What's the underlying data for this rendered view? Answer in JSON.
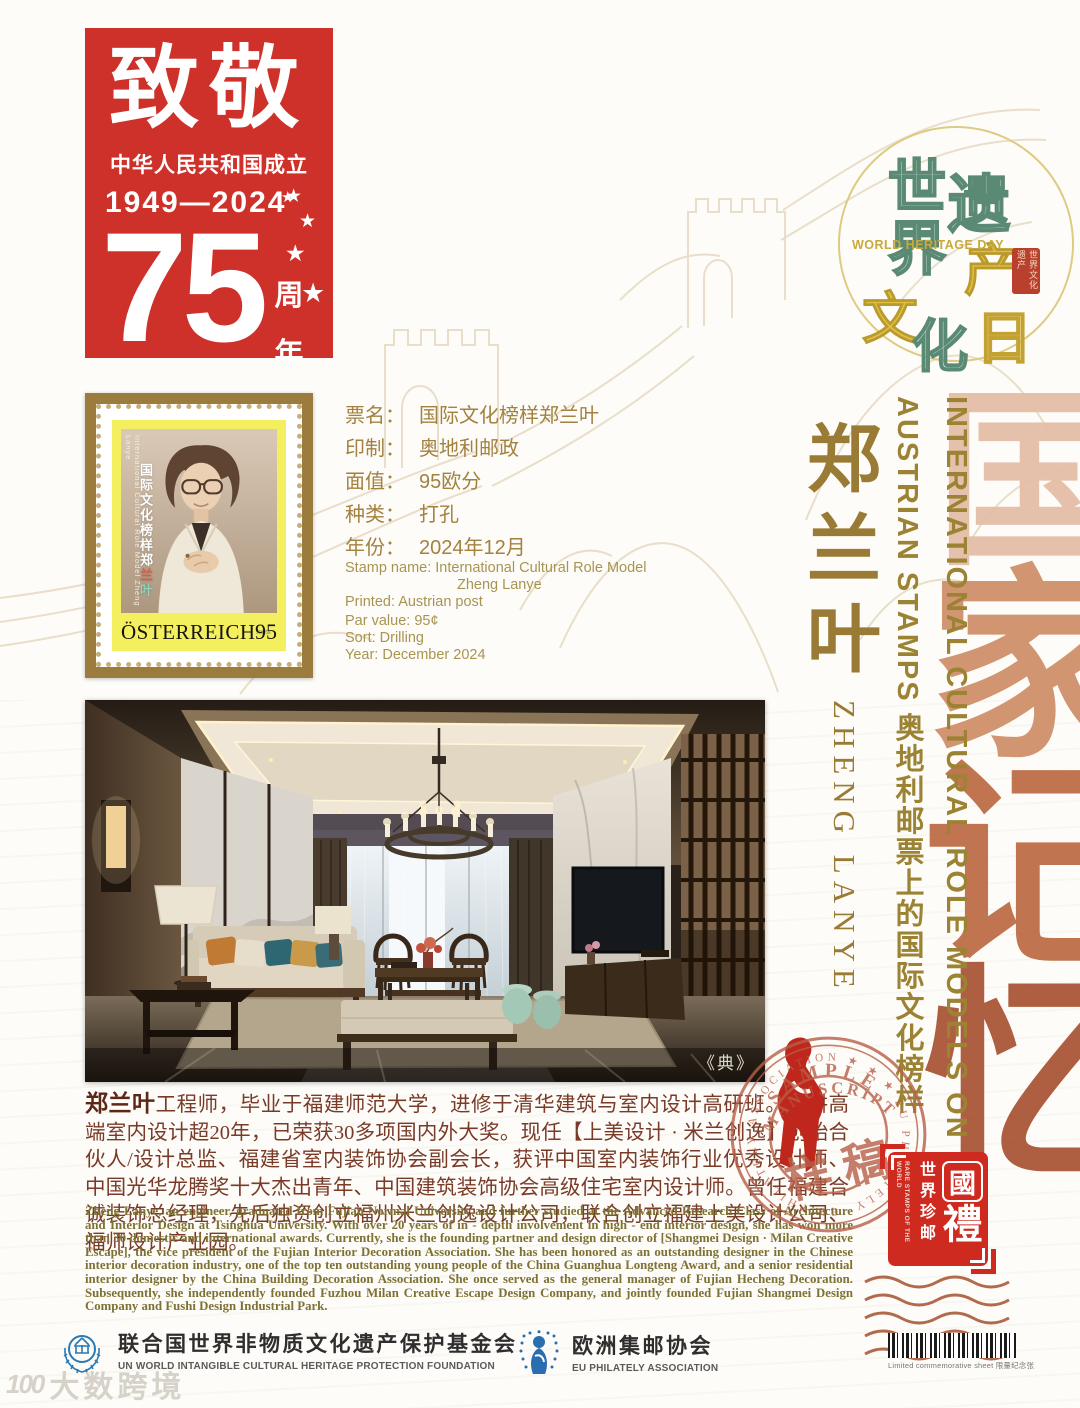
{
  "colors": {
    "badge_red": "#ce312a",
    "gold_text": "#9c8334",
    "bronze_frame": "#9b7c3c",
    "stamp_yellow": "#f4ef5f",
    "seal_red": "#b65f48",
    "guoli_red": "#cf2a1f",
    "memory_copper": "#bb6a42"
  },
  "anniversary_badge": {
    "title": "致敬",
    "subtitle": "中华人民共和国成立",
    "years": "1949—2024",
    "star": "★",
    "number": "75",
    "unit_top": "周",
    "unit_bottom": "年"
  },
  "heritage_logo": {
    "char_shi": "世",
    "char_jie": "界",
    "char_wen": "文",
    "char_hua": "化",
    "char_yi": "遗",
    "char_chan": "产",
    "char_ri": "日",
    "subtitle": "WORLD HERITAGE DAY",
    "seal_text": "世界文化遗产"
  },
  "stamp": {
    "side_en": "International Cultural Role Model Zheng Lanye",
    "side_zh_main": "国际文化榜样郑",
    "side_zh_red": "兰",
    "side_zh_green": "叶",
    "country": "ÖSTERREICH",
    "denomination": "95"
  },
  "stamp_info_zh": {
    "rows": [
      {
        "label": "票名：",
        "value": "国际文化榜样郑兰叶"
      },
      {
        "label": "印制：",
        "value": "奥地利邮政"
      },
      {
        "label": "面值：",
        "value": "95欧分"
      },
      {
        "label": "种类：",
        "value": "打孔"
      },
      {
        "label": "年份：",
        "value": "2024年12月"
      }
    ]
  },
  "stamp_info_en": {
    "line1": "Stamp name: International Cultural Role Model",
    "line2": "Zheng Lanye",
    "line3": "Printed: Austrian post",
    "line4": "Par value: 95¢",
    "line5": "Sort: Drilling",
    "line6": "Year: December 2024"
  },
  "right_column": {
    "name_zh": "郑兰叶",
    "name_en": "ZHENG LANYE",
    "headline_line1": "INTERNATIONAL CULTURAL ROLE MODELS ON",
    "headline_line2": "AUSTRIAN STAMPS 奥地利邮票上的国际文化榜样",
    "bg_char1": "国",
    "bg_char2": "家",
    "bg_char3": "记",
    "bg_char4": "忆"
  },
  "photo": {
    "caption": "《典》"
  },
  "bio": {
    "name_zh": "郑兰叶",
    "zh": "工程师，毕业于福建师范大学，进修于清华建筑与室内设计高研班。深耕高端室内设计超20年，已荣获30多项国内外大奖。现任【上美设计 · 米兰创逸】创始合伙人/设计总监、福建省室内装饰协会副会长，获评中国室内装饰行业优秀设计师、中国光华龙腾奖十大杰出青年、中国建筑装饰协会高级住宅室内设计师。曾任福建合诚装饰总经理，先后独资创立福州米兰创逸设计公司，联合创立福建上美设计公司、福师设计产业园。",
    "en": "Zheng Lanye, an engineer, graduated from Fujian Normal University and further studied at the Advanced Research Class of Architecture and Interior Design at Tsinghua University. With over 20 years of in - depth involvement in high - end interior design, she has won more than 30 domestic and international awards. Currently, she is the founding partner and design director of [Shangmei Design · Milan Creative Escape], the vice president of the Fujian Interior Decoration Association. She has been honored as an outstanding designer in the Chinese interior decoration industry, one of the top ten outstanding young people of the China Guanghua Longteng Award, and a senior residential interior designer by the China Building Decoration Association. She once served as the general manager of Fujian Hecheng Decoration. Subsequently, she independently founded Fuzhou Milan Creative Escape Design Company, and jointly founded Fujian Shangmei Design Company and Fushi Design Industrial Park."
  },
  "sample_seal": {
    "arc_top": "SAMPLE",
    "arc_mid": "MANUSCRIPT",
    "center": "样 稿",
    "ring_text": "EU PHILATELY ASSOCIATION ★ ★ ★ EU PHILATELY"
  },
  "guoli_badge": {
    "char_guo": "國",
    "char_li": "禮",
    "sub_zh": "世界珍邮",
    "sub_en": "RARE STAMPS OF THE WORLD"
  },
  "footer": {
    "org1_zh": "联合国世界非物质文化遗产保护基金会",
    "org1_en": "UN WORLD INTANGIBLE CULTURAL HERITAGE PROTECTION FOUNDATION",
    "org2_zh": "欧洲集邮协会",
    "org2_en": "EU PHILATELY ASSOCIATION",
    "barcode_caption": "Limited commemorative sheet 限量纪念张"
  },
  "watermark": {
    "logo": "100",
    "text": "大数跨境"
  }
}
